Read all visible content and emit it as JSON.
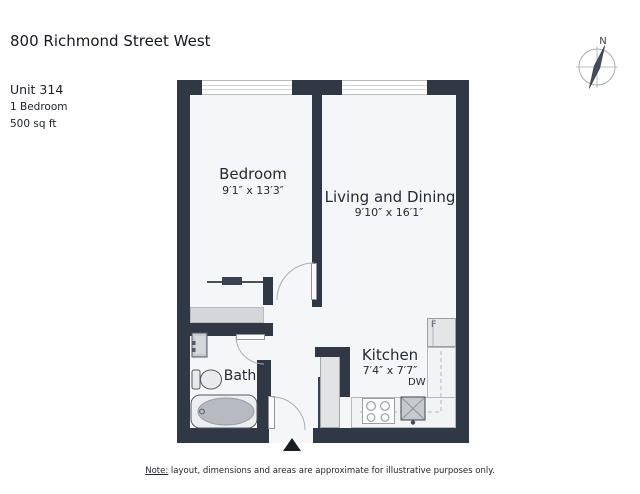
{
  "header": {
    "title": "800 Richmond Street West",
    "unit": "Unit 314",
    "bedrooms": "1 Bedroom",
    "area": "500 sq ft"
  },
  "compass": {
    "north_label": "N"
  },
  "rooms": {
    "bedroom": {
      "name": "Bedroom",
      "dims": "9′1″ x 13′3″"
    },
    "living": {
      "name": "Living and Dining",
      "dims": "9′10″ x 16′1″"
    },
    "kitchen": {
      "name": "Kitchen",
      "dims": "7′4″ x 7′7″"
    },
    "bath": {
      "name": "Bath"
    }
  },
  "appliances": {
    "fridge_label": "F",
    "dishwasher_label": "DW"
  },
  "note": {
    "prefix": "Note:",
    "rest": " layout, dimensions and areas are approximate for illustrative purposes only."
  },
  "colors": {
    "wall": "#313845",
    "floor": "#f5f6f7",
    "fixture_gray": "#c6cace",
    "counter_line": "#b4b8bd"
  }
}
